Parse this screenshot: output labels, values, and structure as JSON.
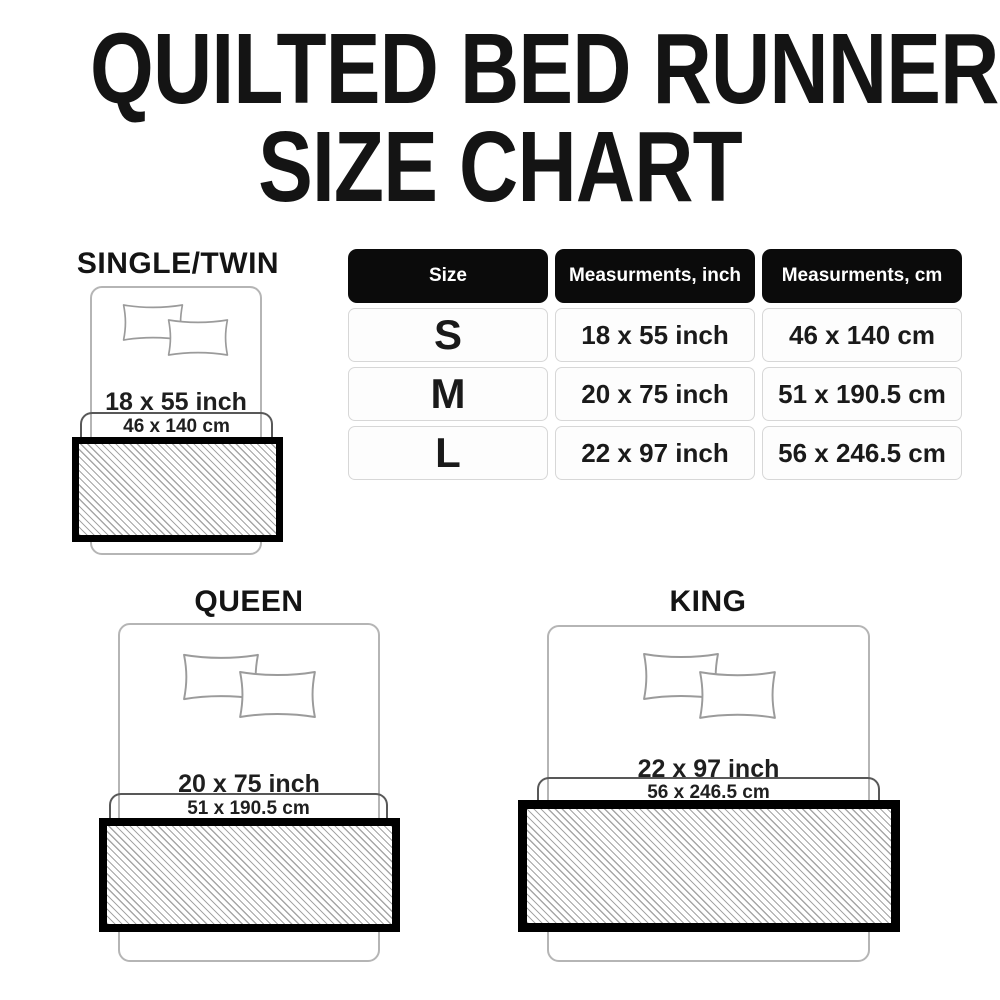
{
  "title": {
    "line1": "QUILTED BED RUNNER",
    "line2": "SIZE CHART"
  },
  "table": {
    "headers": [
      "Size",
      "Measurments, inch",
      "Measurments, cm"
    ],
    "rows": [
      {
        "size": "S",
        "inch": "18 x 55 inch",
        "cm": "46 x 140 cm"
      },
      {
        "size": "M",
        "inch": "20 x 75 inch",
        "cm": "51 x 190.5 cm"
      },
      {
        "size": "L",
        "inch": "22 x 97 inch",
        "cm": "56 x 246.5 cm"
      }
    ]
  },
  "diagrams": [
    {
      "name": "SINGLE/TWIN",
      "inch": "18 x 55 inch",
      "cm": "46 x 140 cm"
    },
    {
      "name": "QUEEN",
      "inch": "20 x 75 inch",
      "cm": "51 x 190.5 cm"
    },
    {
      "name": "KING",
      "inch": "22 x 97 inch",
      "cm": "56 x 246.5 cm"
    }
  ],
  "colors": {
    "background": "#ffffff",
    "title_text": "#141414",
    "header_bg": "#0b0b0b",
    "header_text": "#ffffff",
    "cell_border": "#d7d7d7",
    "cell_text": "#1a1a1a",
    "bed_outline": "#b5b5b5",
    "pillow_outline": "#9b9b9b",
    "bracket_line": "#585858",
    "runner_border": "#000000",
    "hatch_line": "#a6a6a6"
  }
}
